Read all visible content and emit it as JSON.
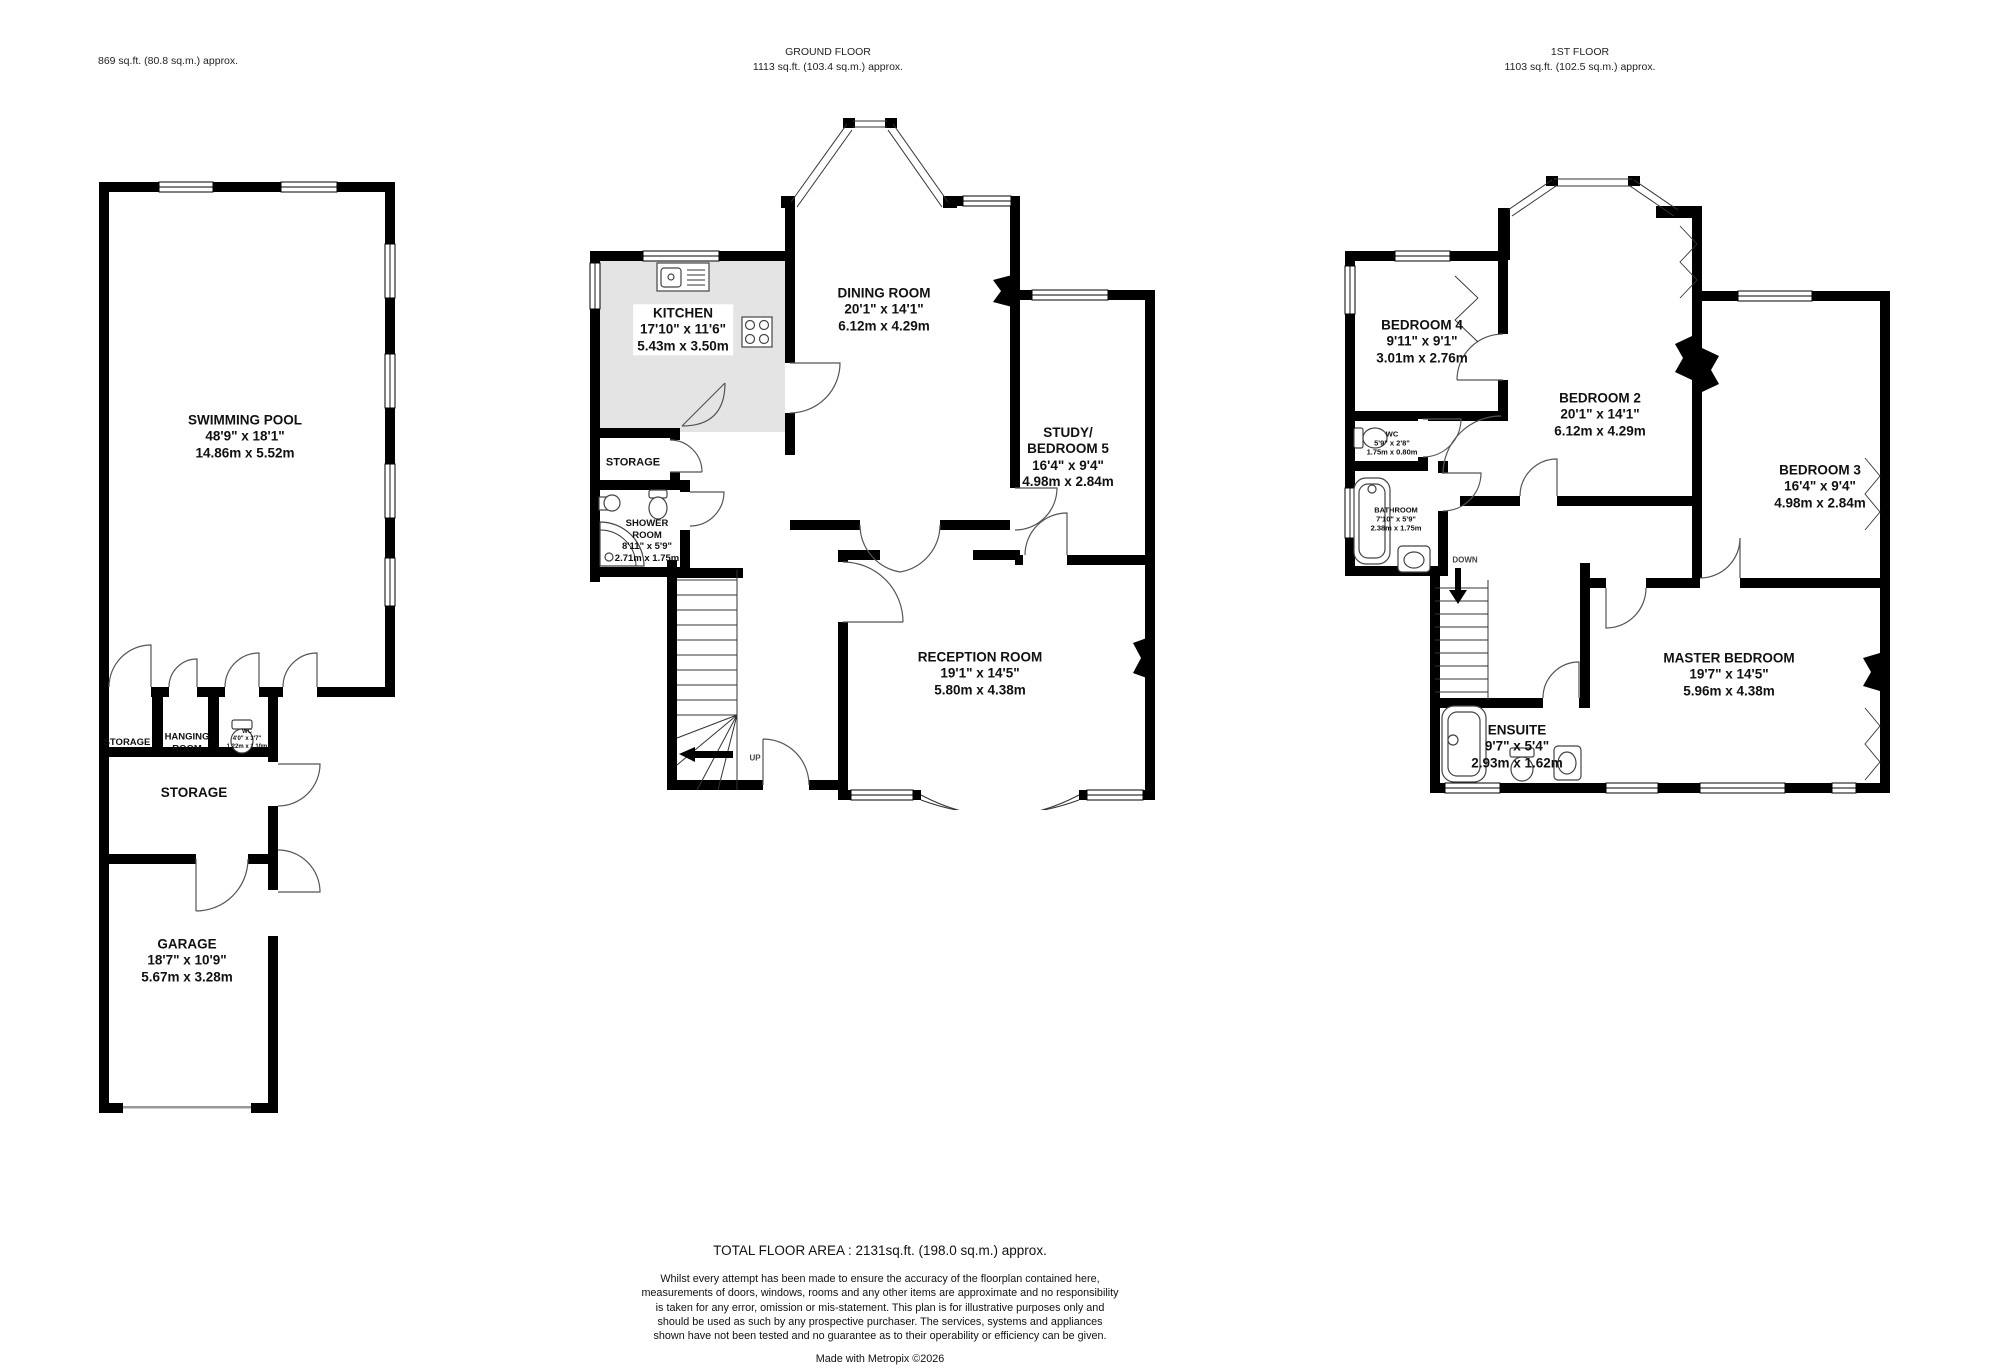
{
  "headers": {
    "pool": {
      "area": "869 sq.ft. (80.8 sq.m.) approx."
    },
    "ground": {
      "title": "GROUND FLOOR",
      "area": "1113 sq.ft. (103.4 sq.m.) approx."
    },
    "first": {
      "title": "1ST FLOOR",
      "area": "1103 sq.ft. (102.5 sq.m.) approx."
    }
  },
  "rooms": {
    "swimming_pool": {
      "name": "SWIMMING POOL",
      "imperial": "48'9\" x 18'1\"",
      "metric": "14.86m x 5.52m"
    },
    "storage_small": {
      "name": "STORAGE"
    },
    "hanging_room": {
      "name": "HANGING ROOM"
    },
    "wc_pool": {
      "name": "WC",
      "imperial": "4'0\" x 3'7\"",
      "metric": "1.22m x 1.10m"
    },
    "storage_band": {
      "name": "STORAGE"
    },
    "garage": {
      "name": "GARAGE",
      "imperial": "18'7\" x 10'9\"",
      "metric": "5.67m x 3.28m"
    },
    "kitchen": {
      "name": "KITCHEN",
      "imperial": "17'10\" x 11'6\"",
      "metric": "5.43m x 3.50m"
    },
    "dining_room": {
      "name": "DINING ROOM",
      "imperial": "20'1\" x 14'1\"",
      "metric": "6.12m x 4.29m"
    },
    "storage_ground": {
      "name": "STORAGE"
    },
    "shower_room": {
      "name": "SHOWER ROOM",
      "imperial": "8'11\" x 5'9\"",
      "metric": "2.71m x 1.75m"
    },
    "study": {
      "name": "STUDY/",
      "name2": "BEDROOM 5",
      "imperial": "16'4\" x 9'4\"",
      "metric": "4.98m x 2.84m"
    },
    "reception_room": {
      "name": "RECEPTION ROOM",
      "imperial": "19'1\" x 14'5\"",
      "metric": "5.80m x 4.38m"
    },
    "bedroom4": {
      "name": "BEDROOM 4",
      "imperial": "9'11\" x 9'1\"",
      "metric": "3.01m x 2.76m"
    },
    "bedroom2": {
      "name": "BEDROOM 2",
      "imperial": "20'1\" x 14'1\"",
      "metric": "6.12m x 4.29m"
    },
    "bedroom3": {
      "name": "BEDROOM 3",
      "imperial": "16'4\" x 9'4\"",
      "metric": "4.98m x 2.84m"
    },
    "wc_first": {
      "name": "WC",
      "imperial": "5'9\" x 2'8\"",
      "metric": "1.75m x 0.80m"
    },
    "bathroom": {
      "name": "BATHROOM",
      "imperial": "7'10\" x 5'9\"",
      "metric": "2.38m x 1.75m"
    },
    "master_bedroom": {
      "name": "MASTER BEDROOM",
      "imperial": "19'7\" x 14'5\"",
      "metric": "5.96m x 4.38m"
    },
    "ensuite": {
      "name": "ENSUITE",
      "imperial": "9'7\" x 5'4\"",
      "metric": "2.93m x 1.62m"
    }
  },
  "stairs": {
    "up": "UP",
    "down": "DOWN"
  },
  "footer": {
    "total": "TOTAL FLOOR AREA : 2131sq.ft. (198.0 sq.m.) approx.",
    "disclaimer": "Whilst every attempt has been made to ensure the accuracy of the floorplan contained here, measurements of doors, windows, rooms and any other items are approximate and no responsibility is taken for any error, omission or mis-statement. This plan is for illustrative purposes only and should be used as such by any prospective purchaser. The services, systems and appliances shown have not been tested and no guarantee as to their operability or efficiency can be given.",
    "credit": "Made with Metropix ©2026"
  }
}
